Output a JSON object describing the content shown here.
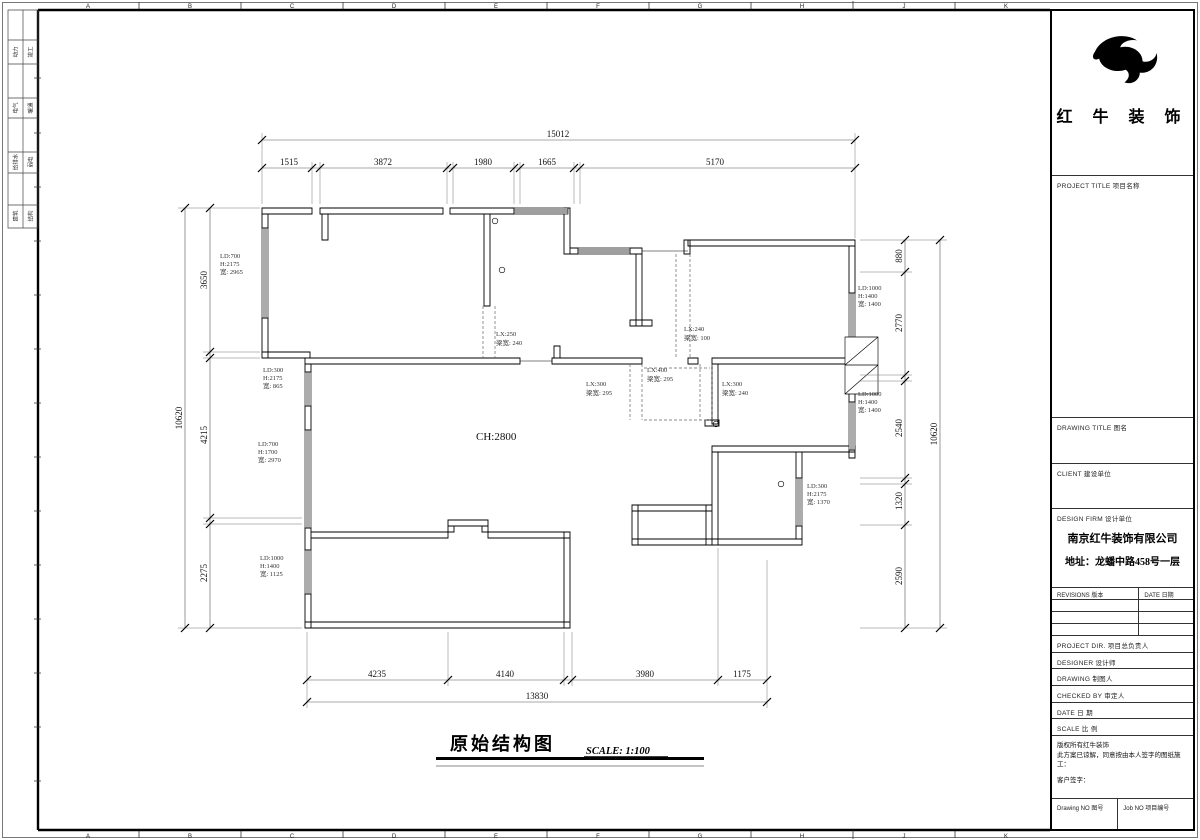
{
  "frame": {
    "grid_letters": [
      "A",
      "B",
      "C",
      "D",
      "E",
      "F",
      "G",
      "H",
      "J",
      "K"
    ]
  },
  "disciplines": [
    [
      "动力",
      "竣工"
    ],
    [
      "电气",
      "暖通"
    ],
    [
      "给排水",
      "弱电"
    ],
    [
      "建筑",
      "结构"
    ]
  ],
  "plan": {
    "title": "原始结构图",
    "scale_note": "SCALE: 1:100",
    "ceiling_height": "CH:2800",
    "dims": {
      "top_total": "15012",
      "top_segments": [
        "1515",
        "3872",
        "1980",
        "1665",
        "5170"
      ],
      "left_total": "10620",
      "left_segments": [
        "3650",
        "4215",
        "2275"
      ],
      "right_total": "10620",
      "right_segments": [
        "880",
        "2770",
        "2540",
        "1320",
        "2590"
      ],
      "bottom_total": "13830",
      "bottom_segments": [
        "4235",
        "4140",
        "3980",
        "1175"
      ]
    },
    "window_labels": [
      [
        "LD:700",
        "H:2175",
        "宽: 2965"
      ],
      [
        "LD:300",
        "H:2175",
        "宽: 865"
      ],
      [
        "LD:700",
        "H:1700",
        "宽: 2970"
      ],
      [
        "LD:1000",
        "H:1400",
        "宽: 1125"
      ],
      [
        "LD:1000",
        "H:1400",
        "宽: 1400"
      ],
      [
        "LD:1000",
        "H:1400",
        "宽: 1400"
      ],
      [
        "LD:300",
        "H:2175",
        "宽: 1370"
      ]
    ],
    "beam_labels": [
      [
        "LX:250",
        "梁宽: 240"
      ],
      [
        "LX:240",
        "梁宽: 100"
      ],
      [
        "LX:400",
        "梁宽: 295"
      ],
      [
        "LX:300",
        "梁宽: 295"
      ],
      [
        "LX:300",
        "梁宽: 240"
      ]
    ]
  },
  "titleblock": {
    "brand": "红 牛 装 饰",
    "project": "PROJECT TITLE   项目名称",
    "drawing": "DRAWING TITLE   图名",
    "client": "CLIENT   建设单位",
    "firm": "DESIGN FIRM   设计单位",
    "company": "南京红牛装饰有限公司",
    "address": "地址：龙蟠中路458号一层",
    "revisions": "REVISIONS 版本",
    "date_col": "DATE 日期",
    "rows": [
      "PROJECT DIR.   项目总负责人",
      "DESIGNER   设计师",
      "DRAWING   制图人",
      "CHECKED BY   审定人",
      "DATE   日  期",
      "SCALE   比  例"
    ],
    "copyright1": "版权所有红牛装饰",
    "copyright2": "此方案已谅解，同意按由本人签字的图纸施工：",
    "signature": "客户签字：",
    "drawing_no": "Drawing NO  图号",
    "job_no": "Job NO  项目编号"
  }
}
